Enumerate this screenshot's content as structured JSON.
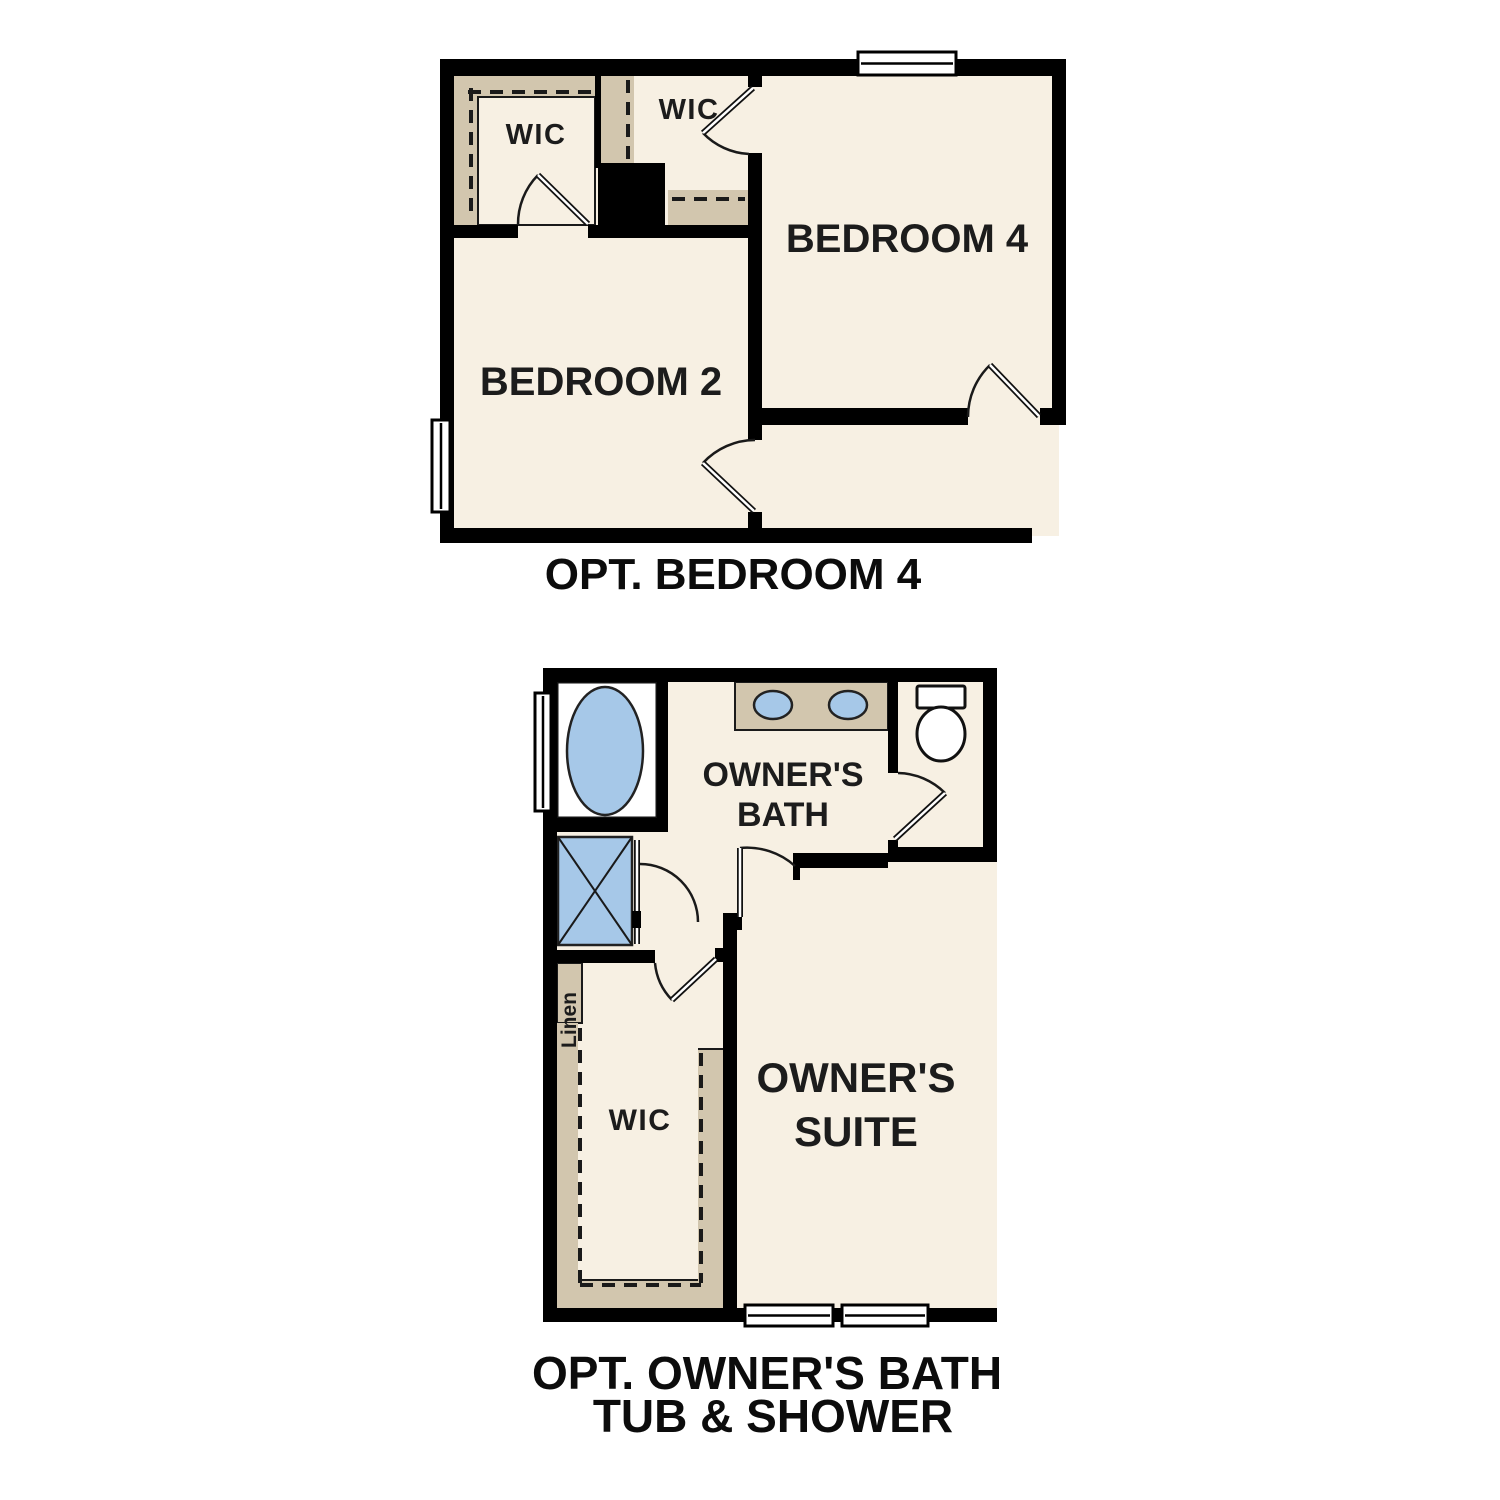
{
  "colors": {
    "background": "#ffffff",
    "wall": "#000000",
    "floor": "#f7f0e3",
    "shelf": "#d2c6ae",
    "fixture_blue": "#a6c8e8",
    "fixture_white": "#ffffff",
    "line": "#1a1a1a",
    "label": "#1c1c1c"
  },
  "plan_bedroom4": {
    "caption": "OPT. BEDROOM 4",
    "labels": {
      "wic_left": "WIC",
      "wic_right": "WIC",
      "bedroom2": "BEDROOM 2",
      "bedroom4": "BEDROOM 4"
    }
  },
  "plan_owners_bath": {
    "caption_line1": "OPT. OWNER'S BATH",
    "caption_line2": "TUB & SHOWER",
    "labels": {
      "bath_line1": "OWNER'S",
      "bath_line2": "BATH",
      "suite_line1": "OWNER'S",
      "suite_line2": "SUITE",
      "wic": "WIC",
      "linen": "Linen"
    }
  }
}
